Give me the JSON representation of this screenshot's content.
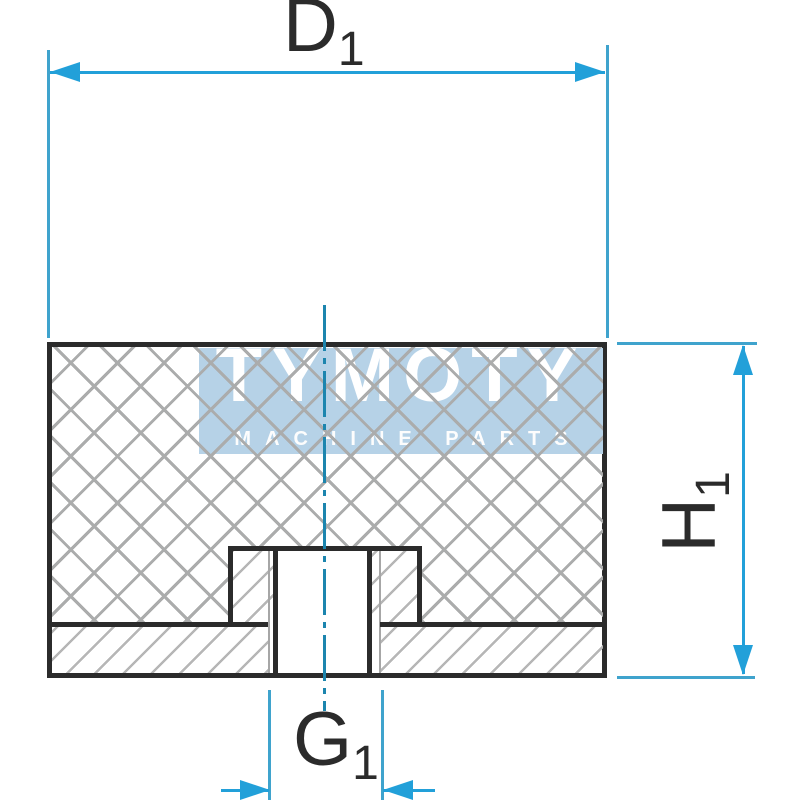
{
  "drawing": {
    "dimensions": {
      "d1": {
        "main": "D",
        "sub": "1"
      },
      "h1": {
        "main": "H",
        "sub": "1"
      },
      "g1": {
        "main": "G",
        "sub": "1"
      }
    },
    "watermark": {
      "title": "TYMOTY",
      "subtitle": "MACHINE PARTS"
    },
    "colors": {
      "dimension_accent": "#22a0d9",
      "extension_line": "#3fa3cd",
      "centerline": "#1c85ae",
      "part_outline": "#2b2b2b",
      "crosshatch": "#abacac",
      "metal_hatch": "#b6b6b6",
      "watermark_band": "#b6d2e7",
      "watermark_text": "#ffffff",
      "background": "#ffffff"
    }
  }
}
